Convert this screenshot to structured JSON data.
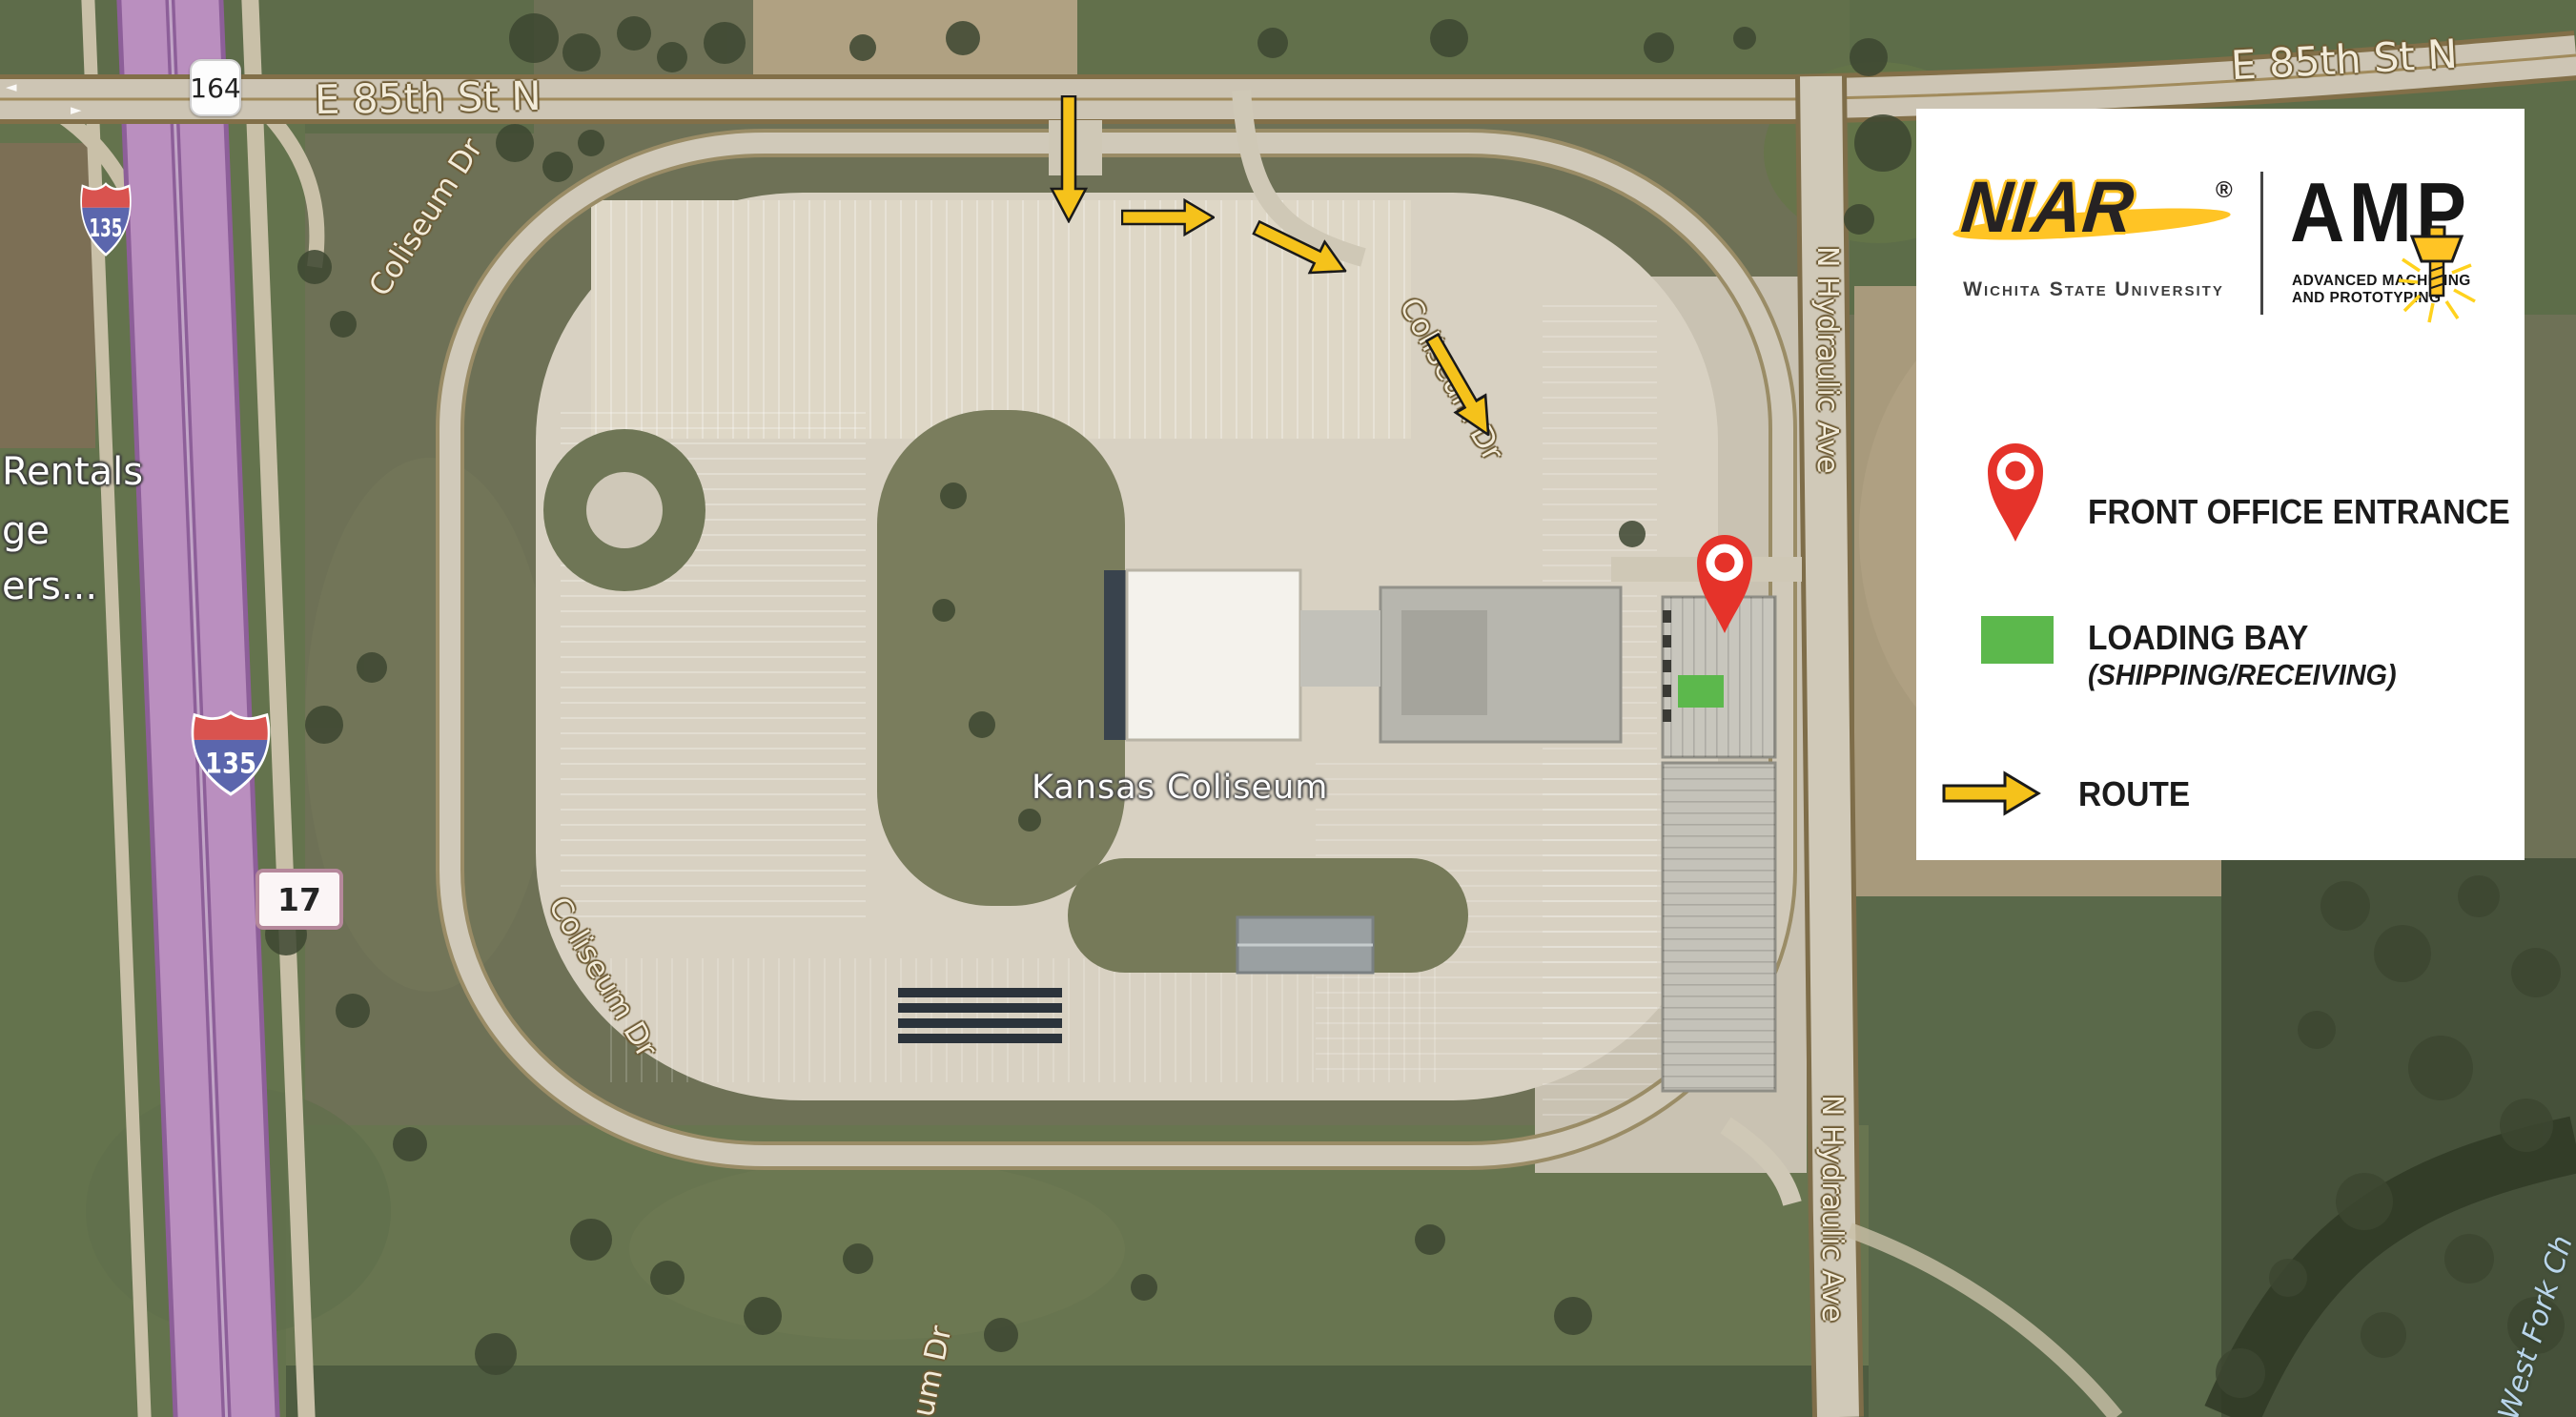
{
  "map": {
    "streets": {
      "e85th": "E 85th St N",
      "coliseum_dr": "Coliseum Dr",
      "coliseum_dr_frag": "um Dr",
      "hydraulic": "N Hydraulic Ave"
    },
    "place": "Kansas Coliseum",
    "water": "West Fork Ch",
    "poi_fragments": [
      "Rentals",
      "ge",
      "ers..."
    ],
    "shields": {
      "interstate": "135",
      "route": "164",
      "marker": "17"
    },
    "lane_arrows": {
      "left": "◄",
      "right": "►"
    }
  },
  "legend": {
    "niar": "NIAR",
    "registered": "®",
    "university": "Wichita State University",
    "amp": "AMP",
    "amp_line1": "ADVANCED MACHINING",
    "amp_line2": "AND PROTOTYPING",
    "front_office": "FRONT OFFICE ENTRANCE",
    "loading_bay": "LOADING BAY",
    "shipping": "(SHIPPING/RECEIVING)",
    "route": "ROUTE"
  },
  "colors": {
    "route_arrow": "#F5C21B",
    "pin_red": "#E5332A",
    "loading_green": "#5CB84C",
    "highway_purple": "#BA8FBF",
    "brand_yellow": "#FFC425"
  }
}
